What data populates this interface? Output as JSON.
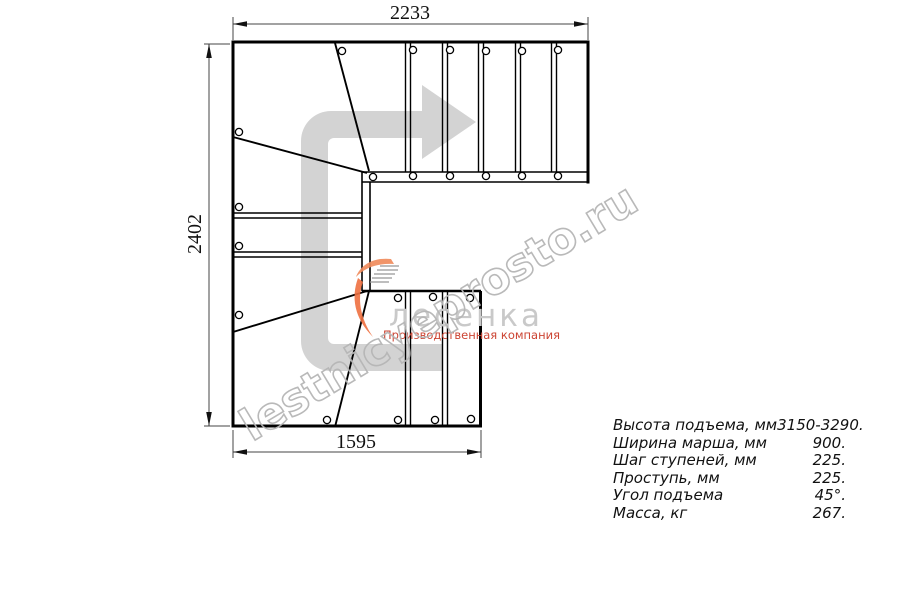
{
  "drawing": {
    "title": "L/U-turn winder staircase plan view",
    "dimensions": {
      "top": "2233",
      "left": "2402",
      "bottom": "1595"
    },
    "watermark": "lestnicyeprosto.ru",
    "icons": {
      "direction_arrow": "u-turn-right-direction-arrow-icon",
      "balusters": "baluster-circle-markers"
    }
  },
  "logo": {
    "name": "лесенка",
    "tagline": "Производственная компания",
    "icon": "stair-flame-icon"
  },
  "specs": {
    "rows": [
      {
        "label": "Высота подъема, мм",
        "value": "3150-3290."
      },
      {
        "label": "Ширина марша, мм",
        "value": "900."
      },
      {
        "label": "Шаг ступеней, мм",
        "value": "225."
      },
      {
        "label": "Проступь, мм",
        "value": "225."
      },
      {
        "label": "Угол подъема",
        "value": "45°."
      },
      {
        "label": "Масса, кг",
        "value": "267."
      }
    ]
  },
  "colors": {
    "line": "#000000",
    "dimension": "#333333",
    "arrow_fill": "#d3d3d3",
    "watermark": "#b6b6b6",
    "logo_text": "#c9c9c9",
    "logo_accent": "#ee7040",
    "tagline": "#cc4433",
    "background": "#ffffff"
  }
}
